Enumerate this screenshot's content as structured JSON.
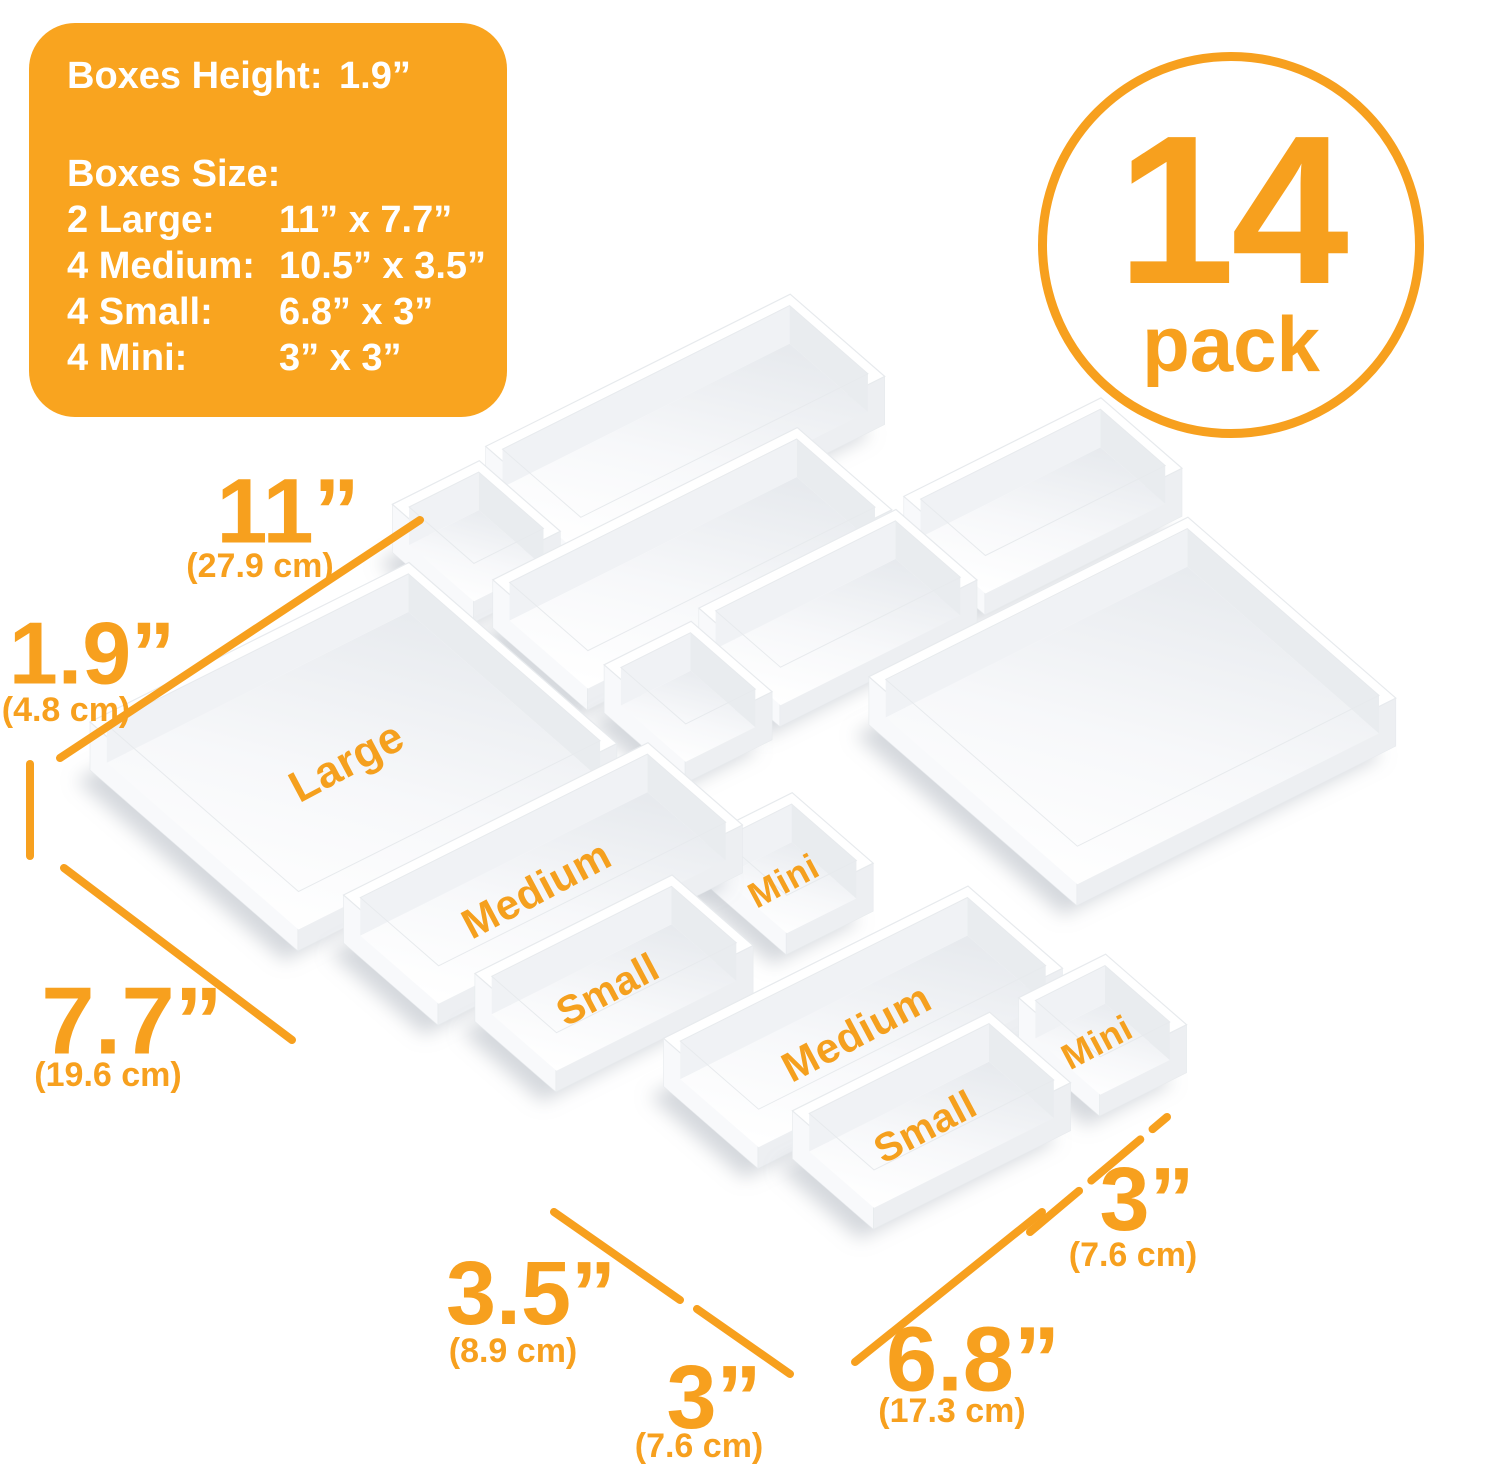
{
  "colors": {
    "accent_orange": "#F7A01E",
    "panel_bg": "#F9A41F",
    "label_orange": "#F5A01E",
    "rim_top": "#ffffff",
    "face_left": "#f8f9fb",
    "face_right": "#edeff2",
    "wall_nw": "#f0f2f5",
    "wall_ne": "#e9ecef",
    "floor_dark": "#e7eaee",
    "floor_mid": "#f7f8fa",
    "floor_light": "#ffffff",
    "edge": "#e7eaed",
    "shadow": "rgba(150,158,170,0.40)"
  },
  "info_panel": {
    "height_label": "Boxes Height:",
    "height_value": "1.9”",
    "size_label": "Boxes Size:",
    "rows": [
      {
        "label": "2 Large:",
        "value": "11” x 7.7”"
      },
      {
        "label": "4 Medium:",
        "value": "10.5” x 3.5”"
      },
      {
        "label": "4 Small:",
        "value": "6.8” x 3”"
      },
      {
        "label": "4 Mini:",
        "value": "3” x 3”"
      }
    ]
  },
  "badge": {
    "number": "14",
    "word": "pack"
  },
  "scene": {
    "projection": {
      "ux": 29,
      "uy": -14.5,
      "vx": 27,
      "vy": 23.5,
      "ox": 90,
      "oy": 770,
      "lift": 48,
      "floor_drop": 38,
      "wall": 0.3
    },
    "label_sizes": {
      "large": 44,
      "medium": 42,
      "small": 40,
      "mini": 36
    },
    "label_rotation": -28,
    "boxes": [
      {
        "name": "medium-back-1",
        "size": "medium",
        "label": "",
        "u": 15.6,
        "v": -2.1,
        "w": 10.5,
        "h": 3.5
      },
      {
        "name": "mini-back-1",
        "size": "mini",
        "label": "",
        "u": 12.1,
        "v": -1.8,
        "w": 3,
        "h": 3
      },
      {
        "name": "medium-back-2",
        "size": "medium",
        "label": "",
        "u": 12.4,
        "v": 1.6,
        "w": 10.5,
        "h": 3.5
      },
      {
        "name": "mini-back-2",
        "size": "mini",
        "label": "",
        "u": 12.7,
        "v": 5.4,
        "w": 3,
        "h": 3
      },
      {
        "name": "small-back-1",
        "size": "small",
        "label": "",
        "u": 16.2,
        "v": 5.15,
        "w": 6.8,
        "h": 3
      },
      {
        "name": "small-back-2",
        "size": "small",
        "label": "",
        "u": 23.5,
        "v": 4.9,
        "w": 6.8,
        "h": 3
      },
      {
        "name": "large-back",
        "size": "large",
        "label": "",
        "u": 18.2,
        "v": 9.3,
        "w": 11,
        "h": 7.7
      },
      {
        "name": "large-front",
        "size": "large",
        "label": "Large",
        "u": 0,
        "v": 0,
        "w": 11,
        "h": 7.7
      },
      {
        "name": "medium-front-1",
        "size": "medium",
        "label": "Medium",
        "u": 1.2,
        "v": 8.1,
        "w": 10.5,
        "h": 3.5
      },
      {
        "name": "small-front-1",
        "size": "small",
        "label": "Small",
        "u": 2.1,
        "v": 12.0,
        "w": 6.8,
        "h": 3
      },
      {
        "name": "mini-front-1",
        "size": "mini",
        "label": "Mini",
        "u": 10.6,
        "v": 11.4,
        "w": 3,
        "h": 3
      },
      {
        "name": "medium-front-2",
        "size": "medium",
        "label": "Medium",
        "u": 4.6,
        "v": 16.3,
        "w": 10.5,
        "h": 3.5
      },
      {
        "name": "small-front-2",
        "size": "small",
        "label": "Small",
        "u": 5.6,
        "v": 20.0,
        "w": 6.8,
        "h": 3
      },
      {
        "name": "mini-front-2",
        "size": "mini",
        "label": "Mini",
        "u": 13.4,
        "v": 20.0,
        "w": 3,
        "h": 3
      }
    ]
  },
  "dimensions": [
    {
      "name": "dim-11",
      "value": "11”",
      "cm": "(27.9 cm)",
      "text": {
        "x": 288,
        "y": 518,
        "size": 92
      },
      "cm_pos": {
        "x": 260,
        "y": 568
      },
      "line": {
        "x1": 60,
        "y1": 758,
        "x2": 420,
        "y2": 520
      }
    },
    {
      "name": "dim-1-9",
      "value": "1.9”",
      "cm": "(4.8 cm)",
      "text": {
        "x": 92,
        "y": 660,
        "size": 88
      },
      "cm_pos": {
        "x": 66,
        "y": 712
      },
      "line": {
        "x1": 30,
        "y1": 764,
        "x2": 30,
        "y2": 856
      }
    },
    {
      "name": "dim-7-7",
      "value": "7.7”",
      "cm": "(19.6 cm)",
      "text": {
        "x": 132,
        "y": 1028,
        "size": 96
      },
      "cm_pos": {
        "x": 108,
        "y": 1077
      },
      "line": {
        "x1": 64,
        "y1": 868,
        "x2": 292,
        "y2": 1040
      }
    },
    {
      "name": "dim-3-5",
      "value": "3.5”",
      "cm": "(8.9 cm)",
      "text": {
        "x": 531,
        "y": 1300,
        "size": 90
      },
      "cm_pos": {
        "x": 513,
        "y": 1353
      },
      "line": {
        "x1": 554,
        "y1": 1212,
        "x2": 680,
        "y2": 1300
      }
    },
    {
      "name": "dim-3-bottom",
      "value": "3”",
      "cm": "(7.6 cm)",
      "text": {
        "x": 714,
        "y": 1404,
        "size": 90
      },
      "cm_pos": {
        "x": 699,
        "y": 1448
      },
      "line": {
        "x1": 697,
        "y1": 1309,
        "x2": 790,
        "y2": 1374
      }
    },
    {
      "name": "dim-6-8",
      "value": "6.8”",
      "cm": "(17.3 cm)",
      "text": {
        "x": 973,
        "y": 1366,
        "size": 92
      },
      "cm_pos": {
        "x": 952,
        "y": 1413
      },
      "line": {
        "x1": 855,
        "y1": 1362,
        "x2": 1042,
        "y2": 1212
      }
    },
    {
      "name": "dim-3-right",
      "value": "3”",
      "cm": "(7.6 cm)",
      "text": {
        "x": 1147,
        "y": 1206,
        "size": 90
      },
      "cm_pos": {
        "x": 1133,
        "y": 1257
      },
      "line": {
        "x1": 1030,
        "y1": 1232,
        "x2": 1167,
        "y2": 1117
      },
      "dash": "64 16"
    }
  ]
}
